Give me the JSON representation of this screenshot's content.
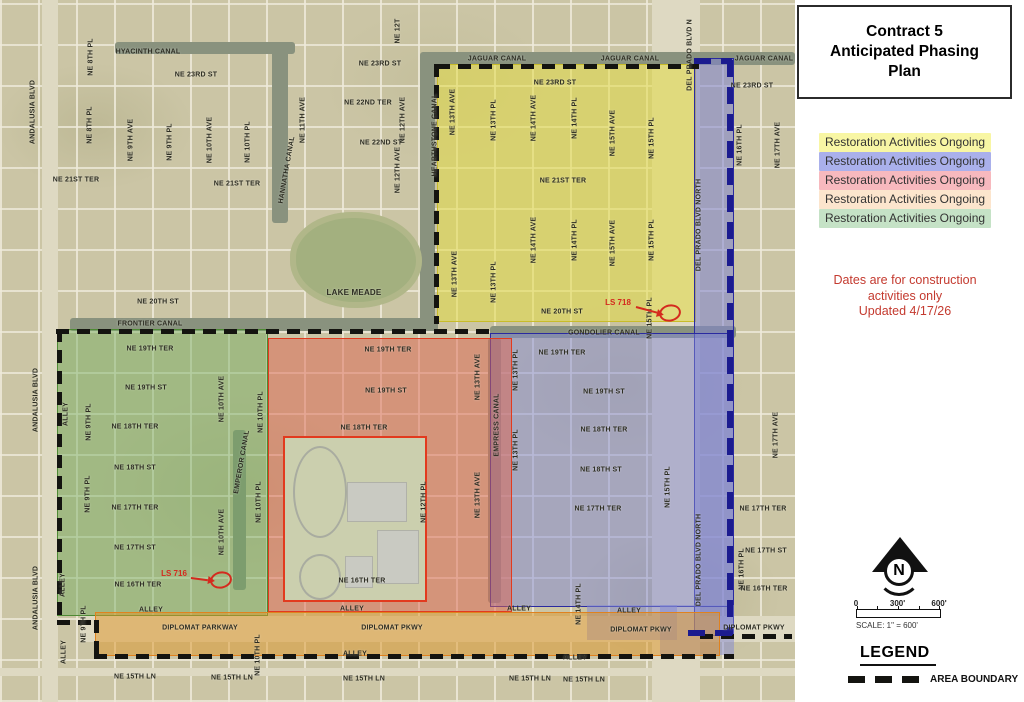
{
  "panel": {
    "title": "Contract 5 Anticipated Phasing Plan",
    "legend_items": [
      {
        "label": "Restoration Activities Ongoing",
        "color": "#f8f6a4"
      },
      {
        "label": "Restoration Activities Ongoing",
        "color": "#aab0eb"
      },
      {
        "label": "Restoration Activities Ongoing",
        "color": "#f7b9be"
      },
      {
        "label": "Restoration Activities Ongoing",
        "color": "#fce5cd"
      },
      {
        "label": "Restoration Activities Ongoing",
        "color": "#c5e2c6"
      }
    ],
    "notes": [
      "Dates are for construction",
      "activities only",
      "Updated 4/17/26"
    ],
    "notes_color": "#c43a2f",
    "north_label": "N",
    "scale": {
      "ticks": [
        "0",
        "300'",
        "600'"
      ],
      "label": "SCALE: 1\" = 600'"
    },
    "legend_heading": "LEGEND",
    "area_boundary_label": "AREA BOUNDARY"
  },
  "map": {
    "boundary_colors": {
      "black": "#141410",
      "navy": "#1b1b8f"
    },
    "annotation_color": "#d42a1e",
    "zones": {
      "yellow": {
        "fill": "rgba(226,218,70,0.55)",
        "edge": "#c8bc2a"
      },
      "blue_strip": {
        "fill": "rgba(125,130,210,0.55)",
        "edge": "#2a2aa0"
      },
      "blue_block": {
        "fill": "rgba(130,135,212,0.5)",
        "edge": "#2a2aa0"
      },
      "blue_tab_a": {
        "fill": "rgba(130,135,212,0.5)",
        "edge": "#2a2aa0"
      },
      "blue_tab_b": {
        "fill": "rgba(130,135,212,0.5)",
        "edge": "#2a2aa0"
      },
      "red": {
        "fill": "rgba(222,100,80,0.5)",
        "edge": "#e23a1e"
      },
      "green": {
        "fill": "rgba(110,170,90,0.45)",
        "edge": "#4e8a34"
      },
      "orange": {
        "fill": "rgba(222,150,40,0.5)",
        "edge": "#e0821e"
      }
    },
    "annotations": [
      {
        "label": "LS 718",
        "lx": 618,
        "ly": 303,
        "ax1": 636,
        "ay1": 306,
        "ex": 670,
        "ey": 313
      },
      {
        "label": "LS 716",
        "lx": 174,
        "ly": 574,
        "ax1": 191,
        "ay1": 577,
        "ex": 221,
        "ey": 580
      }
    ],
    "labels": [
      {
        "t": "HYACINTH CANAL",
        "x": 148,
        "y": 52
      },
      {
        "t": "NE 23RD ST",
        "x": 196,
        "y": 75
      },
      {
        "t": "NE 23RD ST",
        "x": 380,
        "y": 64
      },
      {
        "t": "NE 22ND TER",
        "x": 368,
        "y": 103
      },
      {
        "t": "NE 22ND ST",
        "x": 381,
        "y": 143
      },
      {
        "t": "NE 21ST TER",
        "x": 76,
        "y": 180
      },
      {
        "t": "NE 21ST TER",
        "x": 237,
        "y": 184
      },
      {
        "t": "NE 20TH ST",
        "x": 158,
        "y": 302
      },
      {
        "t": "FRONTIER CANAL",
        "x": 150,
        "y": 324
      },
      {
        "t": "LAKE MEADE",
        "x": 354,
        "y": 293,
        "s": 8
      },
      {
        "t": "ANDALUSIA BLVD",
        "x": 33,
        "y": 112,
        "r": -90
      },
      {
        "t": "ANDALUSIA BLVD",
        "x": 36,
        "y": 400,
        "r": -90
      },
      {
        "t": "ANDALUSIA BLVD",
        "x": 36,
        "y": 598,
        "r": -90
      },
      {
        "t": "NE 8TH PL",
        "x": 91,
        "y": 57,
        "r": -90
      },
      {
        "t": "NE 8TH PL",
        "x": 90,
        "y": 125,
        "r": -90
      },
      {
        "t": "NE 9TH AVE",
        "x": 131,
        "y": 140,
        "r": -90
      },
      {
        "t": "NE 9TH PL",
        "x": 170,
        "y": 142,
        "r": -90
      },
      {
        "t": "NE 10TH AVE",
        "x": 210,
        "y": 140,
        "r": -90
      },
      {
        "t": "NE 10TH PL",
        "x": 248,
        "y": 142,
        "r": -90
      },
      {
        "t": "NE 11TH AVE",
        "x": 303,
        "y": 120,
        "r": -90
      },
      {
        "t": "NE 12T",
        "x": 398,
        "y": 31,
        "r": -90
      },
      {
        "t": "NE 12TH AVE",
        "x": 403,
        "y": 120,
        "r": -90
      },
      {
        "t": "NE 12TH AVE",
        "x": 398,
        "y": 170,
        "r": -90
      },
      {
        "t": "HANNATHA CANAL",
        "x": 287,
        "y": 170,
        "r": -80
      },
      {
        "t": "JAGUAR CANAL",
        "x": 497,
        "y": 59
      },
      {
        "t": "JAGUAR CANAL",
        "x": 630,
        "y": 59
      },
      {
        "t": "JAGUAR CANAL",
        "x": 764,
        "y": 59
      },
      {
        "t": "DEL PRADO BLVD N",
        "x": 690,
        "y": 55,
        "r": -90
      },
      {
        "t": "HEARTHSTONE CANAL",
        "x": 435,
        "y": 135,
        "r": -90
      },
      {
        "t": "NE 23RD ST",
        "x": 555,
        "y": 83
      },
      {
        "t": "NE 23RD ST",
        "x": 752,
        "y": 86
      },
      {
        "t": "NE 13TH AVE",
        "x": 453,
        "y": 112,
        "r": -90
      },
      {
        "t": "NE 13TH PL",
        "x": 494,
        "y": 120,
        "r": -90
      },
      {
        "t": "NE 14TH AVE",
        "x": 534,
        "y": 118,
        "r": -90
      },
      {
        "t": "NE 14TH PL",
        "x": 575,
        "y": 118,
        "r": -90
      },
      {
        "t": "NE 15TH AVE",
        "x": 613,
        "y": 133,
        "r": -90
      },
      {
        "t": "NE 15TH PL",
        "x": 652,
        "y": 138,
        "r": -90
      },
      {
        "t": "NE 21ST TER",
        "x": 563,
        "y": 181
      },
      {
        "t": "NE 13TH AVE",
        "x": 455,
        "y": 274,
        "r": -90
      },
      {
        "t": "NE 13TH PL",
        "x": 494,
        "y": 282,
        "r": -90
      },
      {
        "t": "NE 14TH AVE",
        "x": 534,
        "y": 240,
        "r": -90
      },
      {
        "t": "NE 14TH PL",
        "x": 575,
        "y": 240,
        "r": -90
      },
      {
        "t": "NE 15TH AVE",
        "x": 613,
        "y": 243,
        "r": -90
      },
      {
        "t": "NE 15TH PL",
        "x": 652,
        "y": 240,
        "r": -90
      },
      {
        "t": "NE 15TH PL",
        "x": 650,
        "y": 318,
        "r": -90
      },
      {
        "t": "NE 20TH ST",
        "x": 562,
        "y": 312
      },
      {
        "t": "DEL PRADO BLVD NORTH",
        "x": 699,
        "y": 225,
        "r": -90
      },
      {
        "t": "DEL PRADO BLVD NORTH",
        "x": 699,
        "y": 560,
        "r": -90
      },
      {
        "t": "NE 16TH PL",
        "x": 740,
        "y": 145,
        "r": -90
      },
      {
        "t": "NE 17TH AVE",
        "x": 778,
        "y": 145,
        "r": -90
      },
      {
        "t": "GONDOLIER CANAL",
        "x": 604,
        "y": 333
      },
      {
        "t": "EMPRESS CANAL",
        "x": 497,
        "y": 425,
        "r": -90
      },
      {
        "t": "EMPEROR CANAL",
        "x": 242,
        "y": 462,
        "r": -80
      },
      {
        "t": "NE 19TH TER",
        "x": 150,
        "y": 349
      },
      {
        "t": "NE 19TH ST",
        "x": 146,
        "y": 388
      },
      {
        "t": "NE 18TH TER",
        "x": 135,
        "y": 427
      },
      {
        "t": "NE 18TH ST",
        "x": 135,
        "y": 468
      },
      {
        "t": "NE 17TH TER",
        "x": 135,
        "y": 508
      },
      {
        "t": "NE 17TH ST",
        "x": 135,
        "y": 548
      },
      {
        "t": "NE 16TH TER",
        "x": 138,
        "y": 585
      },
      {
        "t": "ALLEY",
        "x": 66,
        "y": 414,
        "r": -90
      },
      {
        "t": "NE 9TH PL",
        "x": 89,
        "y": 422,
        "r": -90
      },
      {
        "t": "NE 10TH AVE",
        "x": 222,
        "y": 399,
        "r": -90
      },
      {
        "t": "NE 9TH PL",
        "x": 88,
        "y": 494,
        "r": -90
      },
      {
        "t": "NE 10TH AVE",
        "x": 222,
        "y": 532,
        "r": -90
      },
      {
        "t": "NE 10TH PL",
        "x": 259,
        "y": 502,
        "r": -90
      },
      {
        "t": "ALLEY",
        "x": 63,
        "y": 585,
        "r": -90
      },
      {
        "t": "ALLEY",
        "x": 151,
        "y": 610
      },
      {
        "t": "NE 19TH TER",
        "x": 388,
        "y": 350
      },
      {
        "t": "NE 19TH ST",
        "x": 386,
        "y": 391
      },
      {
        "t": "NE 18TH TER",
        "x": 364,
        "y": 428
      },
      {
        "t": "NE 10TH PL",
        "x": 261,
        "y": 412,
        "r": -90
      },
      {
        "t": "NE 13TH AVE",
        "x": 478,
        "y": 377,
        "r": -90
      },
      {
        "t": "NE 12TH PL",
        "x": 424,
        "y": 502,
        "r": -90
      },
      {
        "t": "NE 13TH AVE",
        "x": 478,
        "y": 495,
        "r": -90
      },
      {
        "t": "NE 16TH TER",
        "x": 362,
        "y": 581
      },
      {
        "t": "ALLEY",
        "x": 352,
        "y": 609
      },
      {
        "t": "NE 19TH TER",
        "x": 562,
        "y": 353
      },
      {
        "t": "NE 19TH ST",
        "x": 604,
        "y": 392
      },
      {
        "t": "NE 18TH TER",
        "x": 604,
        "y": 430
      },
      {
        "t": "NE 18TH ST",
        "x": 601,
        "y": 470
      },
      {
        "t": "NE 17TH TER",
        "x": 598,
        "y": 509
      },
      {
        "t": "NE 13TH PL",
        "x": 516,
        "y": 370,
        "r": -90
      },
      {
        "t": "NE 13TH PL",
        "x": 516,
        "y": 450,
        "r": -90
      },
      {
        "t": "NE 15TH PL",
        "x": 668,
        "y": 487,
        "r": -90
      },
      {
        "t": "NE 14TH PL",
        "x": 579,
        "y": 604,
        "r": -90
      },
      {
        "t": "ALLEY",
        "x": 519,
        "y": 609
      },
      {
        "t": "ALLEY",
        "x": 629,
        "y": 611
      },
      {
        "t": "NE 17TH AVE",
        "x": 776,
        "y": 435,
        "r": -90
      },
      {
        "t": "NE 17TH TER",
        "x": 763,
        "y": 509
      },
      {
        "t": "NE 17TH ST",
        "x": 766,
        "y": 551
      },
      {
        "t": "NE 16TH PL",
        "x": 742,
        "y": 569,
        "r": -90
      },
      {
        "t": "NE 16TH TER",
        "x": 764,
        "y": 589
      },
      {
        "t": "DIPLOMAT PKWY",
        "x": 754,
        "y": 628
      },
      {
        "t": "DIPLOMAT PARKWAY",
        "x": 200,
        "y": 628
      },
      {
        "t": "DIPLOMAT PKWY",
        "x": 392,
        "y": 628
      },
      {
        "t": "DIPLOMAT PKWY",
        "x": 641,
        "y": 630
      },
      {
        "t": "ALLEY",
        "x": 355,
        "y": 654
      },
      {
        "t": "ALLEY",
        "x": 575,
        "y": 658
      },
      {
        "t": "NE 15TH LN",
        "x": 135,
        "y": 677
      },
      {
        "t": "NE 15TH LN",
        "x": 232,
        "y": 678
      },
      {
        "t": "NE 15TH LN",
        "x": 364,
        "y": 679
      },
      {
        "t": "NE 15TH LN",
        "x": 530,
        "y": 679
      },
      {
        "t": "NE 15TH LN",
        "x": 584,
        "y": 680
      },
      {
        "t": "NE 9TH PL",
        "x": 84,
        "y": 624,
        "r": -90
      },
      {
        "t": "ALLEY",
        "x": 64,
        "y": 652,
        "r": -90
      },
      {
        "t": "NE 10TH PL",
        "x": 258,
        "y": 655,
        "r": -90
      }
    ]
  }
}
